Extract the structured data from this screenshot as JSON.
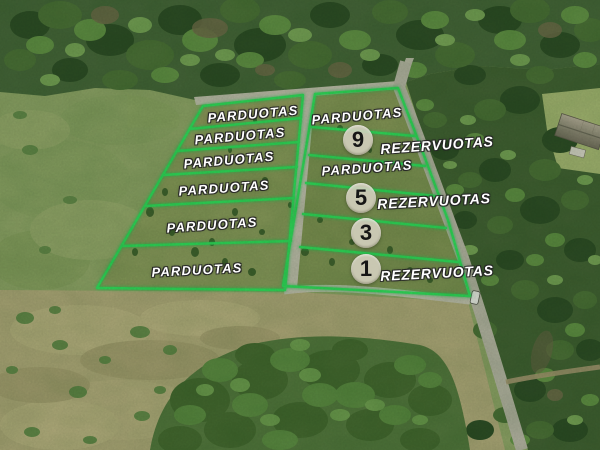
{
  "scene": {
    "description": "Aerial drone photo of rural land plots outlined in green, surrounded by forest, meadow and gravel roads",
    "features": [
      "forest",
      "meadow",
      "gravel-road",
      "white-car",
      "farmhouse-roof",
      "shrub-cluster"
    ]
  },
  "plots": {
    "left": [
      {
        "label": "PARDUOTAS"
      },
      {
        "label": "PARDUOTAS"
      },
      {
        "label": "PARDUOTAS"
      },
      {
        "label": "PARDUOTAS"
      },
      {
        "label": "PARDUOTAS"
      },
      {
        "label": "PARDUOTAS"
      }
    ],
    "right": [
      {
        "label": "PARDUOTAS"
      },
      {
        "number": "9",
        "label": "REZERVUOTAS"
      },
      {
        "label": "PARDUOTAS"
      },
      {
        "number": "5",
        "label": "REZERVUOTAS"
      },
      {
        "number": "3"
      },
      {
        "number": "1",
        "label": "REZERVUOTAS"
      }
    ]
  },
  "legend": {
    "sold_text": "PARDUOTAS",
    "reserved_text": "REZERVUOTAS"
  },
  "colors": {
    "plot_outline": "#32dd5c",
    "label_text": "#ffffff",
    "badge_fill": "#d6d2c1",
    "badge_number": "#161616",
    "road": "#c1bead",
    "forest": "#47653a",
    "meadow": "#b0a87a"
  }
}
